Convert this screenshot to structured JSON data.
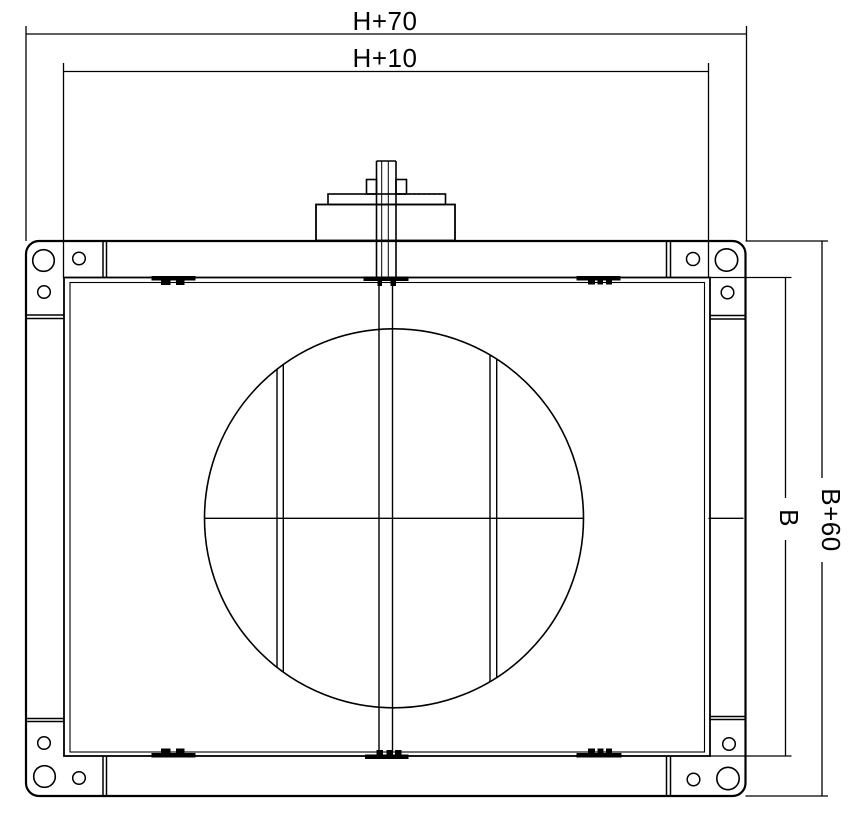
{
  "drawing": {
    "dimension_labels": {
      "width_outer": "H+70",
      "width_inner": "H+10",
      "height_inner": "B",
      "height_outer": "B+60"
    },
    "colors": {
      "line": "#000000",
      "background": "#ffffff"
    }
  }
}
